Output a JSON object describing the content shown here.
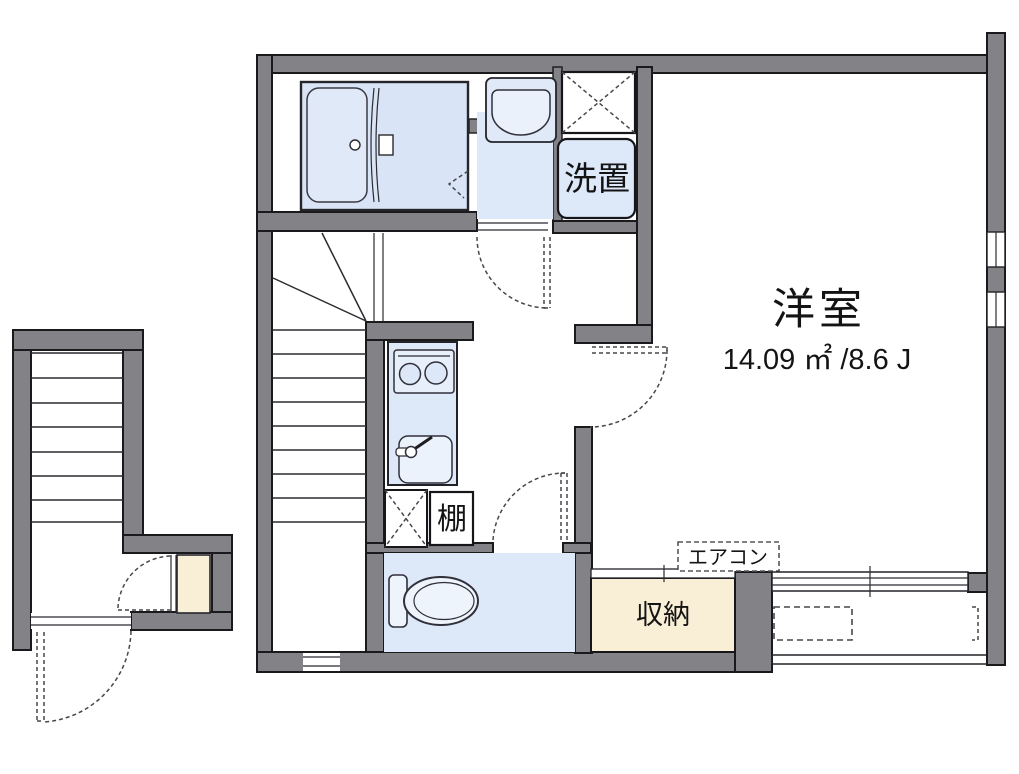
{
  "plan": {
    "main_room": {
      "name": "洋室",
      "area": "14.09 ㎡ /8.6 J"
    },
    "labels": {
      "washer_place": "洗置",
      "shelf": "棚",
      "storage": "収納",
      "air_conditioner": "エアコン"
    },
    "colors": {
      "wall_gray": "#828287",
      "outline_black": "#1a1a1c",
      "fixture_blue": "#dde8f8",
      "fixture_blue_light": "#e9f1fb",
      "storage_cream": "#f9eed6",
      "dashed_line": "#47474d"
    }
  }
}
